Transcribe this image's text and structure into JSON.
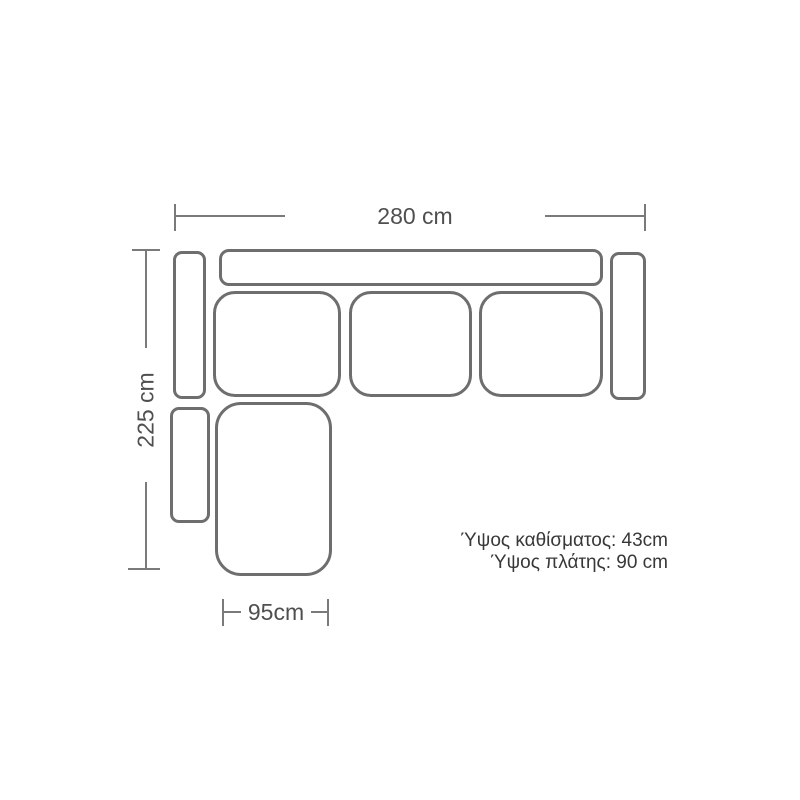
{
  "dimensions": {
    "total_width": "280 cm",
    "total_depth": "225 cm",
    "chaise_width": "95cm"
  },
  "notes": {
    "seat_height": "Ύψος καθίσματος: 43cm",
    "back_height": "Ύψος πλάτης: 90 cm"
  },
  "colors": {
    "outline": "#6e6e6e",
    "dimension_line": "#7a7a7a",
    "label_text": "#4f4f4f",
    "note_text": "#383838",
    "background": "#ffffff"
  }
}
